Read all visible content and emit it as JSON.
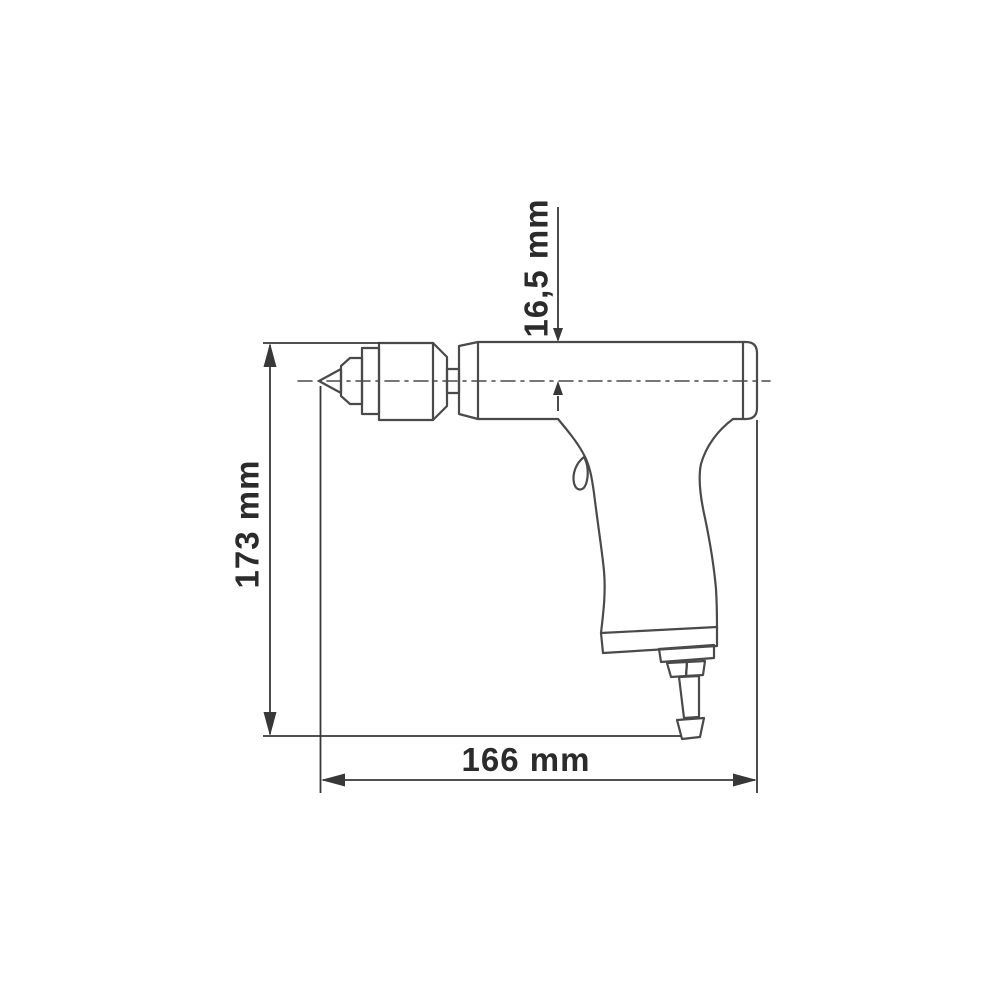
{
  "drawing": {
    "labels": {
      "height": "173 mm",
      "length": "166 mm",
      "axis_offset": "16,5 mm"
    },
    "colors": {
      "background": "#ffffff",
      "outline": "#4a4a4a",
      "dimension": "#383838",
      "text": "#2b2b2b"
    }
  }
}
